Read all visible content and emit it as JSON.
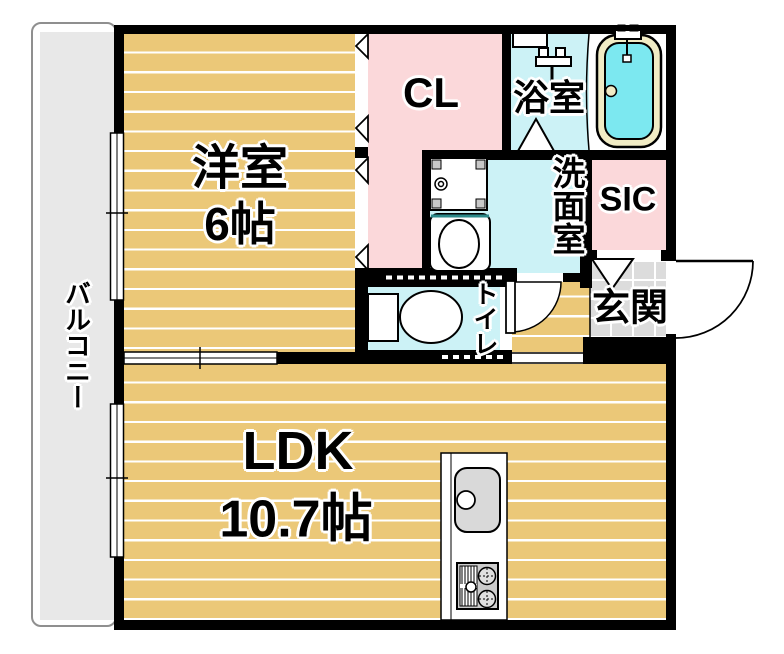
{
  "rooms": {
    "western_room": {
      "label": "洋室",
      "size": "6帖"
    },
    "ldk": {
      "label": "LDK",
      "size": "10.7帖"
    },
    "closet": {
      "label": "CL"
    },
    "bathroom": {
      "label": "浴室"
    },
    "washroom": {
      "label": "洗面室"
    },
    "shoe_closet": {
      "label": "SIC"
    },
    "entrance": {
      "label": "玄関"
    },
    "toilet": {
      "label": "トイレ"
    },
    "balcony": {
      "label": "バルコニー"
    }
  },
  "icons": [
    "bathtub-icon",
    "shower-faucet-icon",
    "bath-mirror-icon",
    "toilet-icon",
    "washing-machine-pan-icon",
    "vanity-sink-icon",
    "kitchen-sink-icon",
    "gas-stove-icon",
    "window-icon",
    "sliding-door-icon",
    "folding-door-icon",
    "door-swing-arc-icon"
  ],
  "colors": {
    "floor_yellow": "#ebc878",
    "room_pink": "#fbd8da",
    "water_cyan": "#ccf2f6",
    "tub_water": "#7ce8f0",
    "tub_rim": "#f1ecc5",
    "balcony_gray": "#e8e8e8",
    "tile_gray": "#dcdcdc",
    "wall_black": "#000000"
  }
}
